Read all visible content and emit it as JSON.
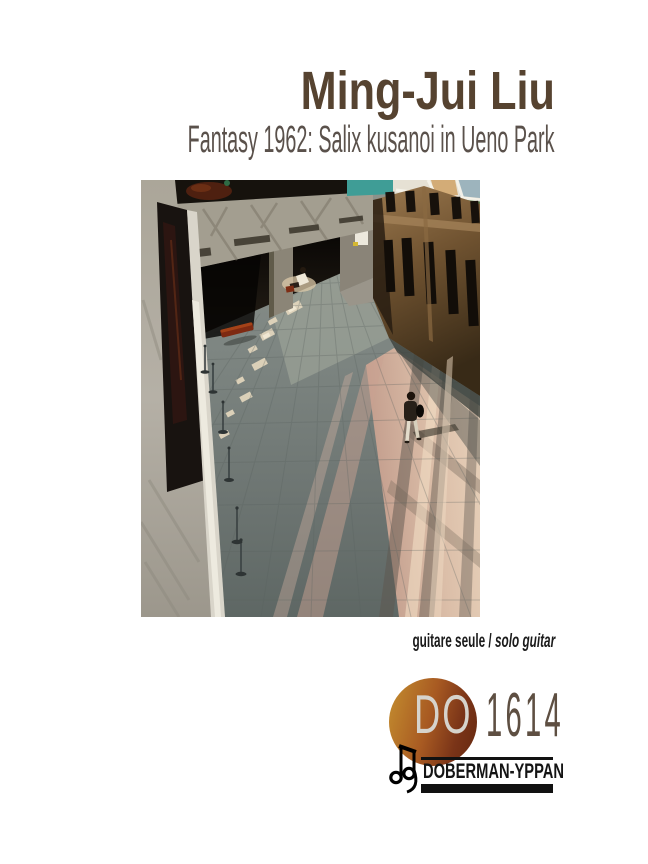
{
  "page": {
    "background": "#ffffff"
  },
  "header": {
    "composer": "Ming-Jui Liu",
    "composer_color": "#564330",
    "title": "Fantasy 1962: Salix kusanoi in Ueno Park",
    "title_color": "#5a514b"
  },
  "photo": {
    "alt": "Overhead view of a museum atrium: concrete mezzanine with tree shadows, dark recess, wooden doors, gray tiled floor crossed by warm sunlight, a walking visitor, a red bench and barrier stanchions"
  },
  "instrumentation": {
    "fr": "guitare seule",
    "separator": " / ",
    "en": "solo guitar"
  },
  "publisher": {
    "catalog_prefix": "DO",
    "catalog_number": "1614",
    "name": "DOBERMAN-YPPAN",
    "circle_gradient": [
      "#c28a2e",
      "#a85a22",
      "#65280f"
    ],
    "prefix_color": "#d6d3cc",
    "number_color": "#5e4f42",
    "bar_color": "#111111"
  }
}
